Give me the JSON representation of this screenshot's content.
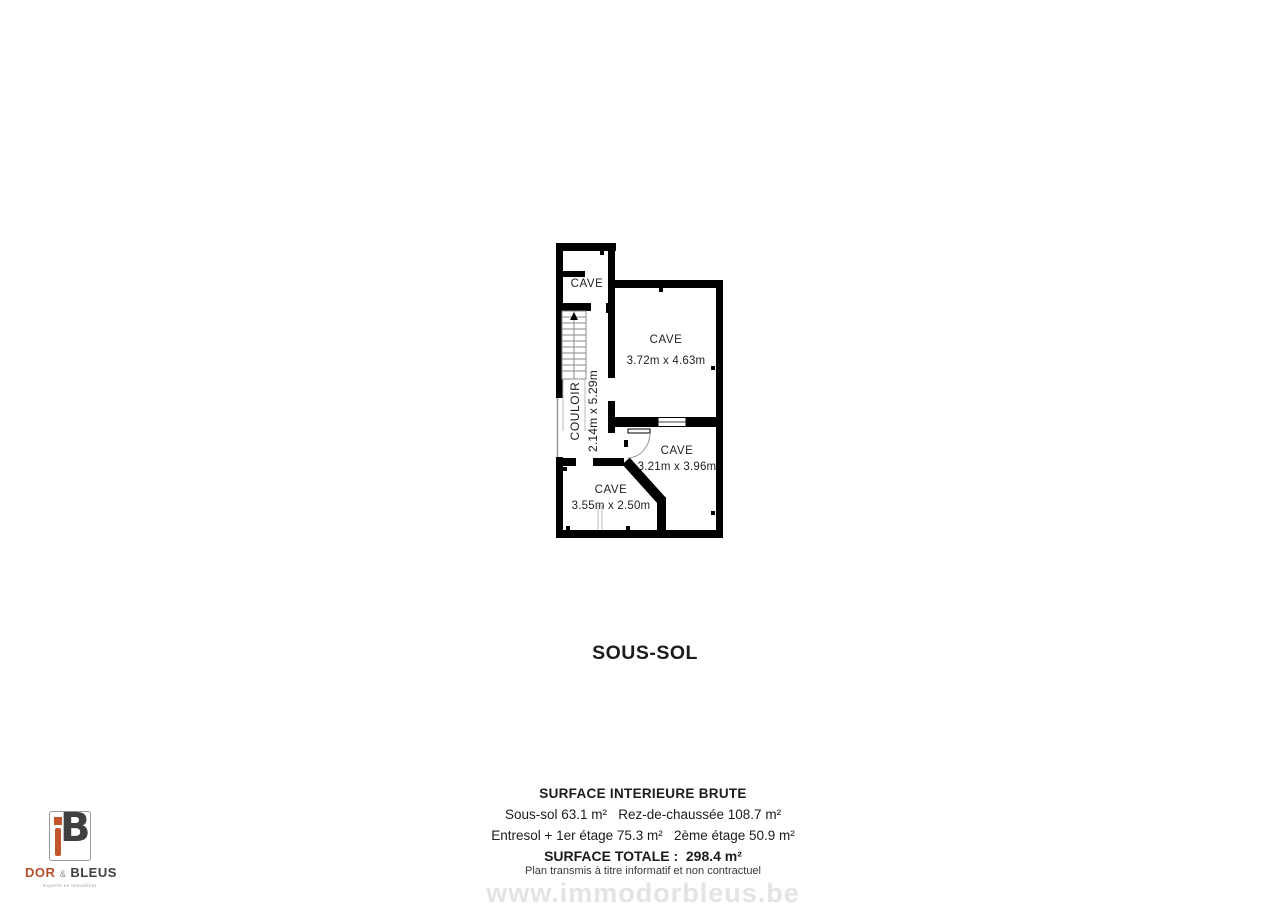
{
  "plan": {
    "rooms": [
      {
        "id": "cave-top",
        "label": "CAVE",
        "dims": ""
      },
      {
        "id": "cave-large",
        "label": "CAVE",
        "dims": "3.72m x 4.63m"
      },
      {
        "id": "couloir",
        "label": "COULOIR",
        "dims": "2.14m x 5.29m"
      },
      {
        "id": "cave-mid",
        "label": "CAVE",
        "dims": "3.21m x 3.96m"
      },
      {
        "id": "cave-small",
        "label": "CAVE",
        "dims": "3.55m x 2.50m"
      }
    ],
    "wall_color": "#000000"
  },
  "title": "SOUS-SOL",
  "surface_summary": {
    "heading": "SURFACE INTERIEURE BRUTE",
    "line1": "Sous-sol 63.1 m²   Rez-de-chaussée 108.7 m²",
    "line2": "Entresol + 1er étage 75.3 m²   2ème étage 50.9 m²",
    "total": "SURFACE TOTALE :  298.4 m²",
    "disclaimer": "Plan transmis à titre informatif et non contractuel"
  },
  "watermark": "www.immodorbleus.be",
  "logo": {
    "monogram": "B",
    "word1": "DOR",
    "amp": "&",
    "word2": "BLEUS",
    "tagline": "Experts en immobilier"
  },
  "colors": {
    "accent_orange": "#c2552c",
    "logo_dark": "#404040",
    "watermark_gray": "#e4e4e4"
  }
}
